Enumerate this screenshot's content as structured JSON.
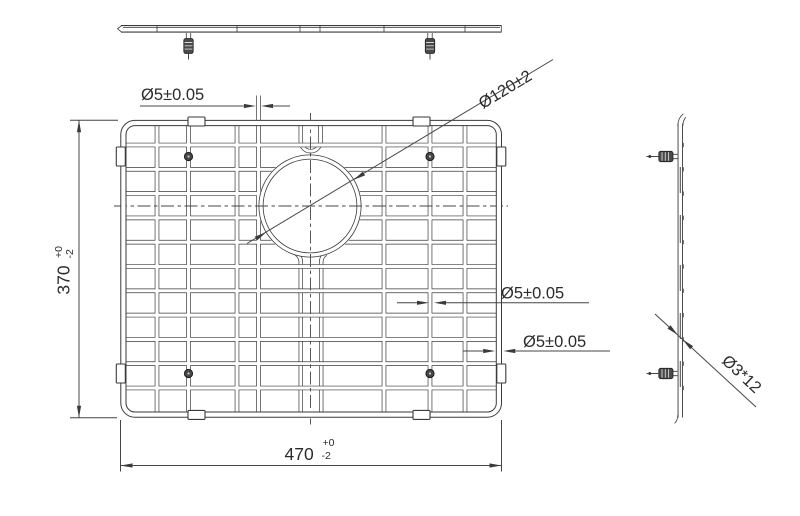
{
  "drawing": {
    "title": "Sink bottom grid engineering drawing",
    "colors": {
      "background": "#ffffff",
      "line": "#3a3a3a",
      "dimension_line": "#454545",
      "text": "#2b2b2b"
    },
    "views": {
      "top_view": "top view",
      "front_view": "front view",
      "side_view": "side view"
    },
    "dimensions": {
      "wire_diameter_top": "Ø5±0.05",
      "center_hole_diameter": "Ø120±2",
      "overall_height": {
        "value": "370",
        "tol_upper": "+0",
        "tol_lower": "-2"
      },
      "overall_width": {
        "value": "470",
        "tol_upper": "+0",
        "tol_lower": "-2"
      },
      "wire_diameter_middle": "Ø5±0.05",
      "wire_diameter_frame": "Ø5±0.05",
      "foot_size": "Ø3*12"
    }
  }
}
